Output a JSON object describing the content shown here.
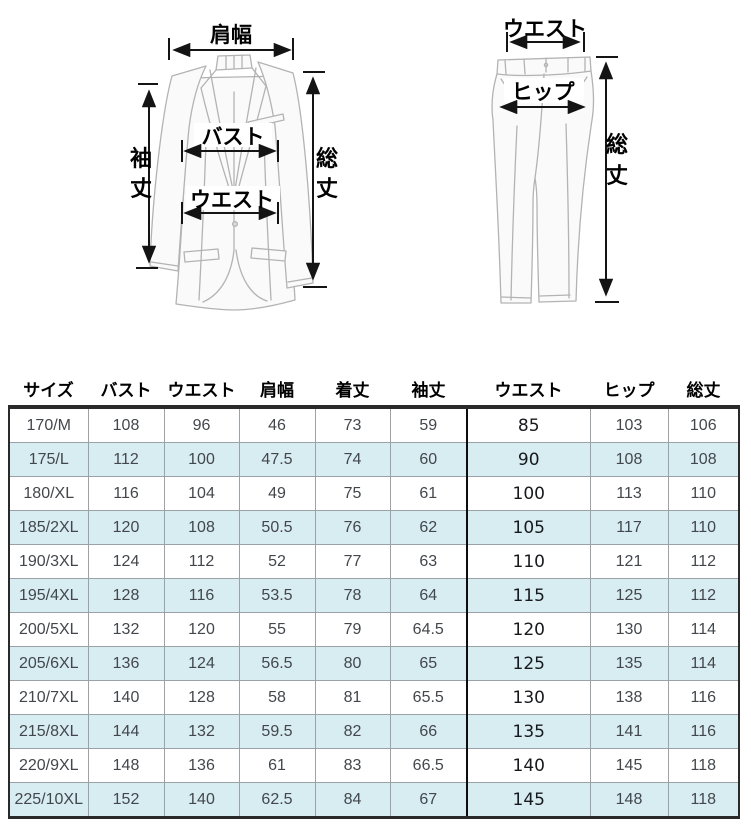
{
  "diagram": {
    "jacket": {
      "shoulder_width_label": "肩幅",
      "bust_label": "バスト",
      "waist_label": "ウエスト",
      "sleeve_char_top": "袖",
      "sleeve_char_bottom": "丈",
      "total_char_top": "総",
      "total_char_bottom": "丈"
    },
    "pants": {
      "waist_label": "ウエスト",
      "hip_label": "ヒップ",
      "total_char_top": "総",
      "total_char_bottom": "丈"
    }
  },
  "table": {
    "headers": [
      "サイズ",
      "バスト",
      "ウエスト",
      "肩幅",
      "着丈",
      "袖丈",
      "ウエスト",
      "ヒップ",
      "総丈"
    ],
    "rows": [
      [
        "170/M",
        "108",
        "96",
        "46",
        "73",
        "59",
        "85",
        "103",
        "106"
      ],
      [
        "175/L",
        "112",
        "100",
        "47.5",
        "74",
        "60",
        "90",
        "108",
        "108"
      ],
      [
        "180/XL",
        "116",
        "104",
        "49",
        "75",
        "61",
        "100",
        "113",
        "110"
      ],
      [
        "185/2XL",
        "120",
        "108",
        "50.5",
        "76",
        "62",
        "105",
        "117",
        "110"
      ],
      [
        "190/3XL",
        "124",
        "112",
        "52",
        "77",
        "63",
        "110",
        "121",
        "112"
      ],
      [
        "195/4XL",
        "128",
        "116",
        "53.5",
        "78",
        "64",
        "115",
        "125",
        "112"
      ],
      [
        "200/5XL",
        "132",
        "120",
        "55",
        "79",
        "64.5",
        "120",
        "130",
        "114"
      ],
      [
        "205/6XL",
        "136",
        "124",
        "56.5",
        "80",
        "65",
        "125",
        "135",
        "114"
      ],
      [
        "210/7XL",
        "140",
        "128",
        "58",
        "81",
        "65.5",
        "130",
        "138",
        "116"
      ],
      [
        "215/8XL",
        "144",
        "132",
        "59.5",
        "82",
        "66",
        "135",
        "141",
        "116"
      ],
      [
        "220/9XL",
        "148",
        "136",
        "61",
        "83",
        "66.5",
        "140",
        "145",
        "118"
      ],
      [
        "225/10XL",
        "152",
        "140",
        "62.5",
        "84",
        "67",
        "145",
        "148",
        "118"
      ]
    ],
    "colors": {
      "row_alt": "#d7edf2",
      "grid": "#9aa2a8",
      "frame": "#2a2a2a",
      "divider": "#0d0d0d",
      "cell_text": "#43474c"
    }
  }
}
